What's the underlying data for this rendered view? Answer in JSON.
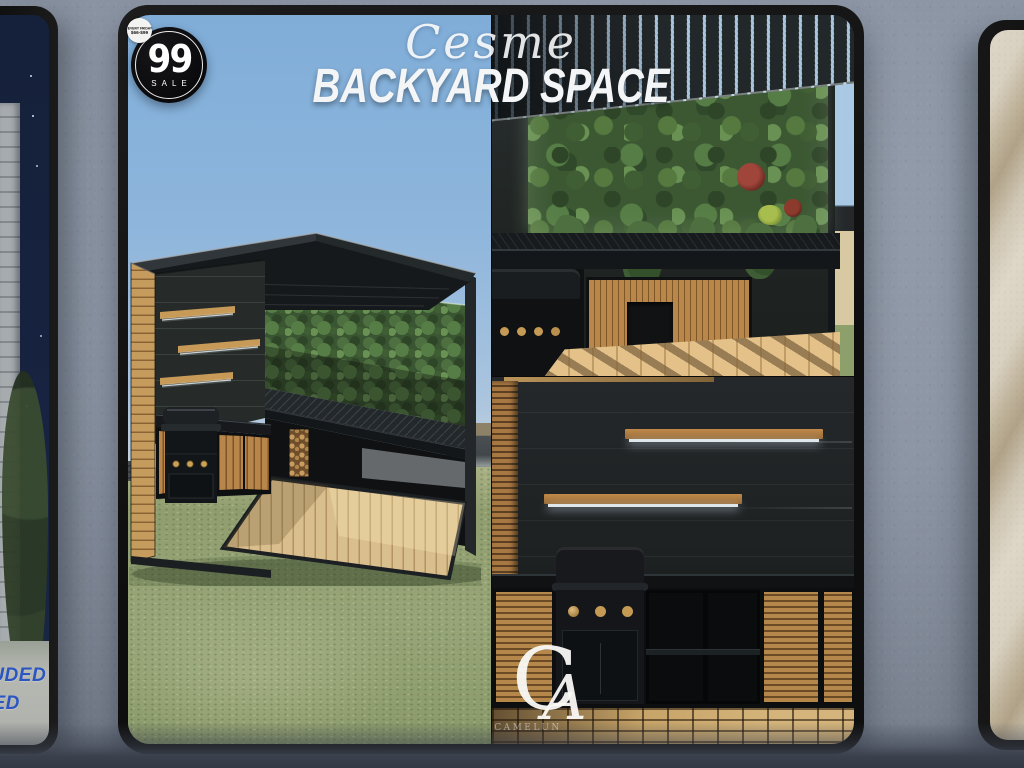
{
  "scene": {
    "environment": "in-world storefront wall with framed ad posters",
    "wall_color": "#8c95a3",
    "floor_shadow_color": "#3a404c",
    "frame_color": "#141414"
  },
  "main_poster": {
    "title_script": "Cesme",
    "title_main": "BACKYARD SPACE",
    "sale_badge": {
      "number": "99",
      "label": "SALE",
      "ribbon_line1": "EVERY FRIDAY",
      "ribbon_line2": "$66-$99",
      "bg_color": "#0b0b0c",
      "fg_color": "#ffffff"
    },
    "brand": {
      "monogram_left": "C",
      "monogram_right": "A",
      "watermark": "CAMELUN"
    },
    "photos": [
      {
        "id": "exterior",
        "desc": "dark pergola cube on lawn under blue sky: living plant wall, lit wood shelves, grill, wood cabinets, deck"
      },
      {
        "id": "interior-top",
        "desc": "slatted pergola roof over backlit living plant wall and outdoor kitchen counter with sun-dappled deck"
      },
      {
        "id": "interior-bottom",
        "desc": "dark slat wall, two lit floating wood shelves, grill with brass knobs, wood cabinets, tiled deck floor"
      }
    ],
    "accent_colors": {
      "wood": "#b9874a",
      "foliage": "#4e7040",
      "sky": "#8fb6dc",
      "grass": "#93a375"
    }
  },
  "left_poster": {
    "desc": "night scene: building siding, bush, pavement",
    "partial_text": [
      "CLUDED",
      "UDED"
    ],
    "text_color": "#2b55c1"
  },
  "right_poster": {
    "desc": "beige diagonal striped pattern"
  }
}
